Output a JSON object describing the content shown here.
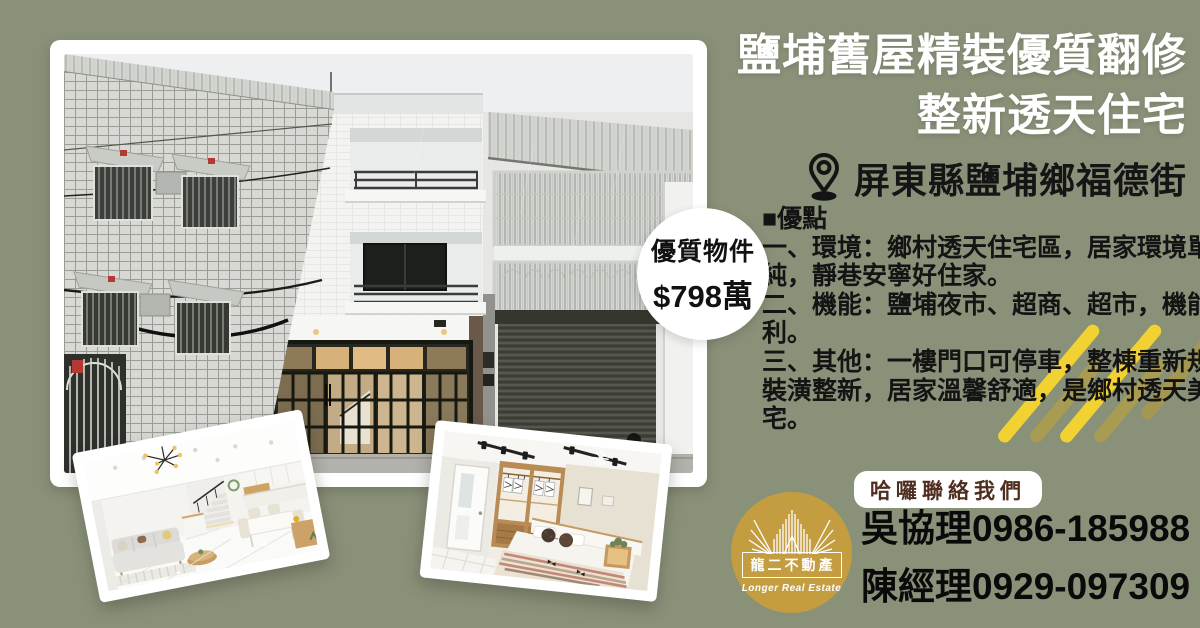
{
  "colors": {
    "background": "#8a9179",
    "stripe_yellow": "#f1d232",
    "stripe_olive": "#a89b52",
    "logo_gold": "#c49d41",
    "pill_text_brown": "#4f2e1f",
    "title_white": "#ffffff",
    "body_text": "#141414"
  },
  "header": {
    "title_line1": "鹽埔舊屋精裝優質翻修",
    "title_line2": "整新透天住宅",
    "location": "屏東縣鹽埔鄉福德街"
  },
  "price_badge": {
    "line1": "優質物件",
    "line2": "$798萬"
  },
  "points": {
    "heading": "■優點",
    "lines": [
      "一、環境：鄉村透天住宅區，居家環境單",
      "純，靜巷安寧好住家。",
      "二、機能：鹽埔夜市、超商、超市，機能便",
      "利。",
      "三、其他：一樓門口可停車，整棟重新規劃",
      "裝潢整新，居家溫馨舒適，是鄉村透天美",
      "宅。"
    ]
  },
  "contact": {
    "pill_label": "哈囉聯絡我們",
    "phone1": "吳協理0986-185988",
    "phone2": "陳經理0929-097309"
  },
  "logo": {
    "name": "龍二不動產",
    "english": "Longer Real Estate"
  }
}
